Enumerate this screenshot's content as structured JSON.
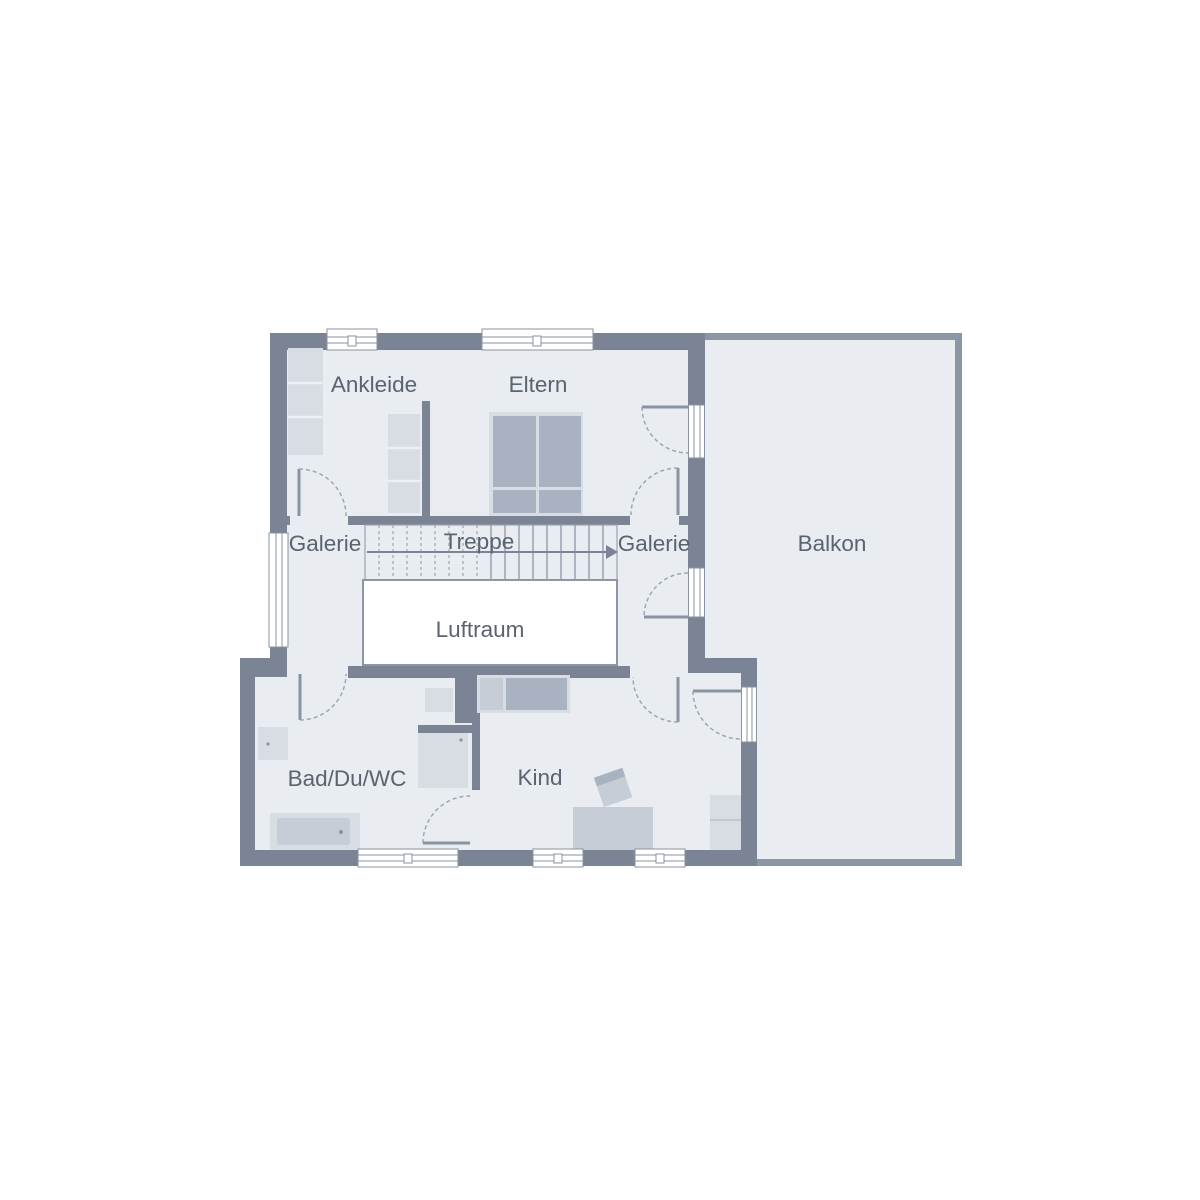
{
  "plan": {
    "rooms": [
      {
        "id": "ankleide",
        "label": "Ankleide"
      },
      {
        "id": "eltern",
        "label": "Eltern"
      },
      {
        "id": "galerie_links",
        "label": "Galerie"
      },
      {
        "id": "treppe",
        "label": "Treppe"
      },
      {
        "id": "galerie_rechts",
        "label": "Galerie"
      },
      {
        "id": "balkon",
        "label": "Balkon"
      },
      {
        "id": "luftraum",
        "label": "Luftraum"
      },
      {
        "id": "bad",
        "label": "Bad/Du/WC"
      },
      {
        "id": "kind",
        "label": "Kind"
      }
    ],
    "colors": {
      "wall": "#7b8494",
      "balcony_wall": "#8d96a4",
      "floor": "#e9ecf0",
      "furniture": "#d8dce3",
      "furniture_dark": "#a9b2c1",
      "symbol_line": "#8a93a1",
      "label_text": "#5a6370",
      "void": "#ffffff"
    }
  }
}
